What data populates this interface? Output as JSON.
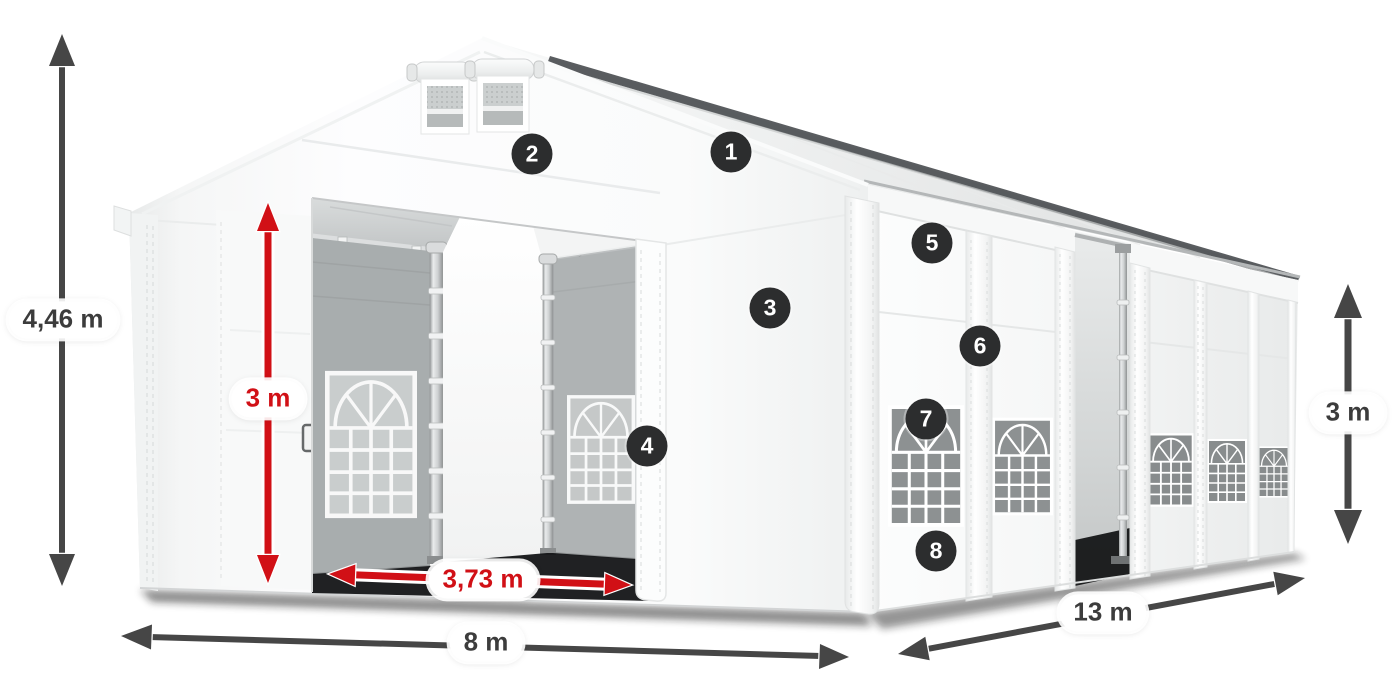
{
  "diagram": {
    "title": "Tent dimension diagram",
    "dimensions": {
      "total_height": {
        "text": "4,46 m",
        "color": "#3c3c3c"
      },
      "entrance_height": {
        "text": "3 m",
        "color": "#d11016"
      },
      "entrance_width": {
        "text": "3,73 m",
        "color": "#d11016"
      },
      "front_width": {
        "text": "8 m",
        "color": "#3c3c3c"
      },
      "side_length": {
        "text": "13 m",
        "color": "#3c3c3c"
      },
      "side_height": {
        "text": "3 m",
        "color": "#3c3c3c"
      }
    },
    "hotspots": [
      {
        "label": "1"
      },
      {
        "label": "2"
      },
      {
        "label": "3"
      },
      {
        "label": "4"
      },
      {
        "label": "5"
      },
      {
        "label": "6"
      },
      {
        "label": "7"
      },
      {
        "label": "8"
      }
    ],
    "colors": {
      "accent_red": "#d11016",
      "arrow_dark": "#464646",
      "badge_bg": "#2c2d2e",
      "pill_bg": "#ffffff",
      "tent_white": "#fbfcfc",
      "interior_gray": "#a8adae",
      "window_glass": "#8d9192"
    }
  }
}
